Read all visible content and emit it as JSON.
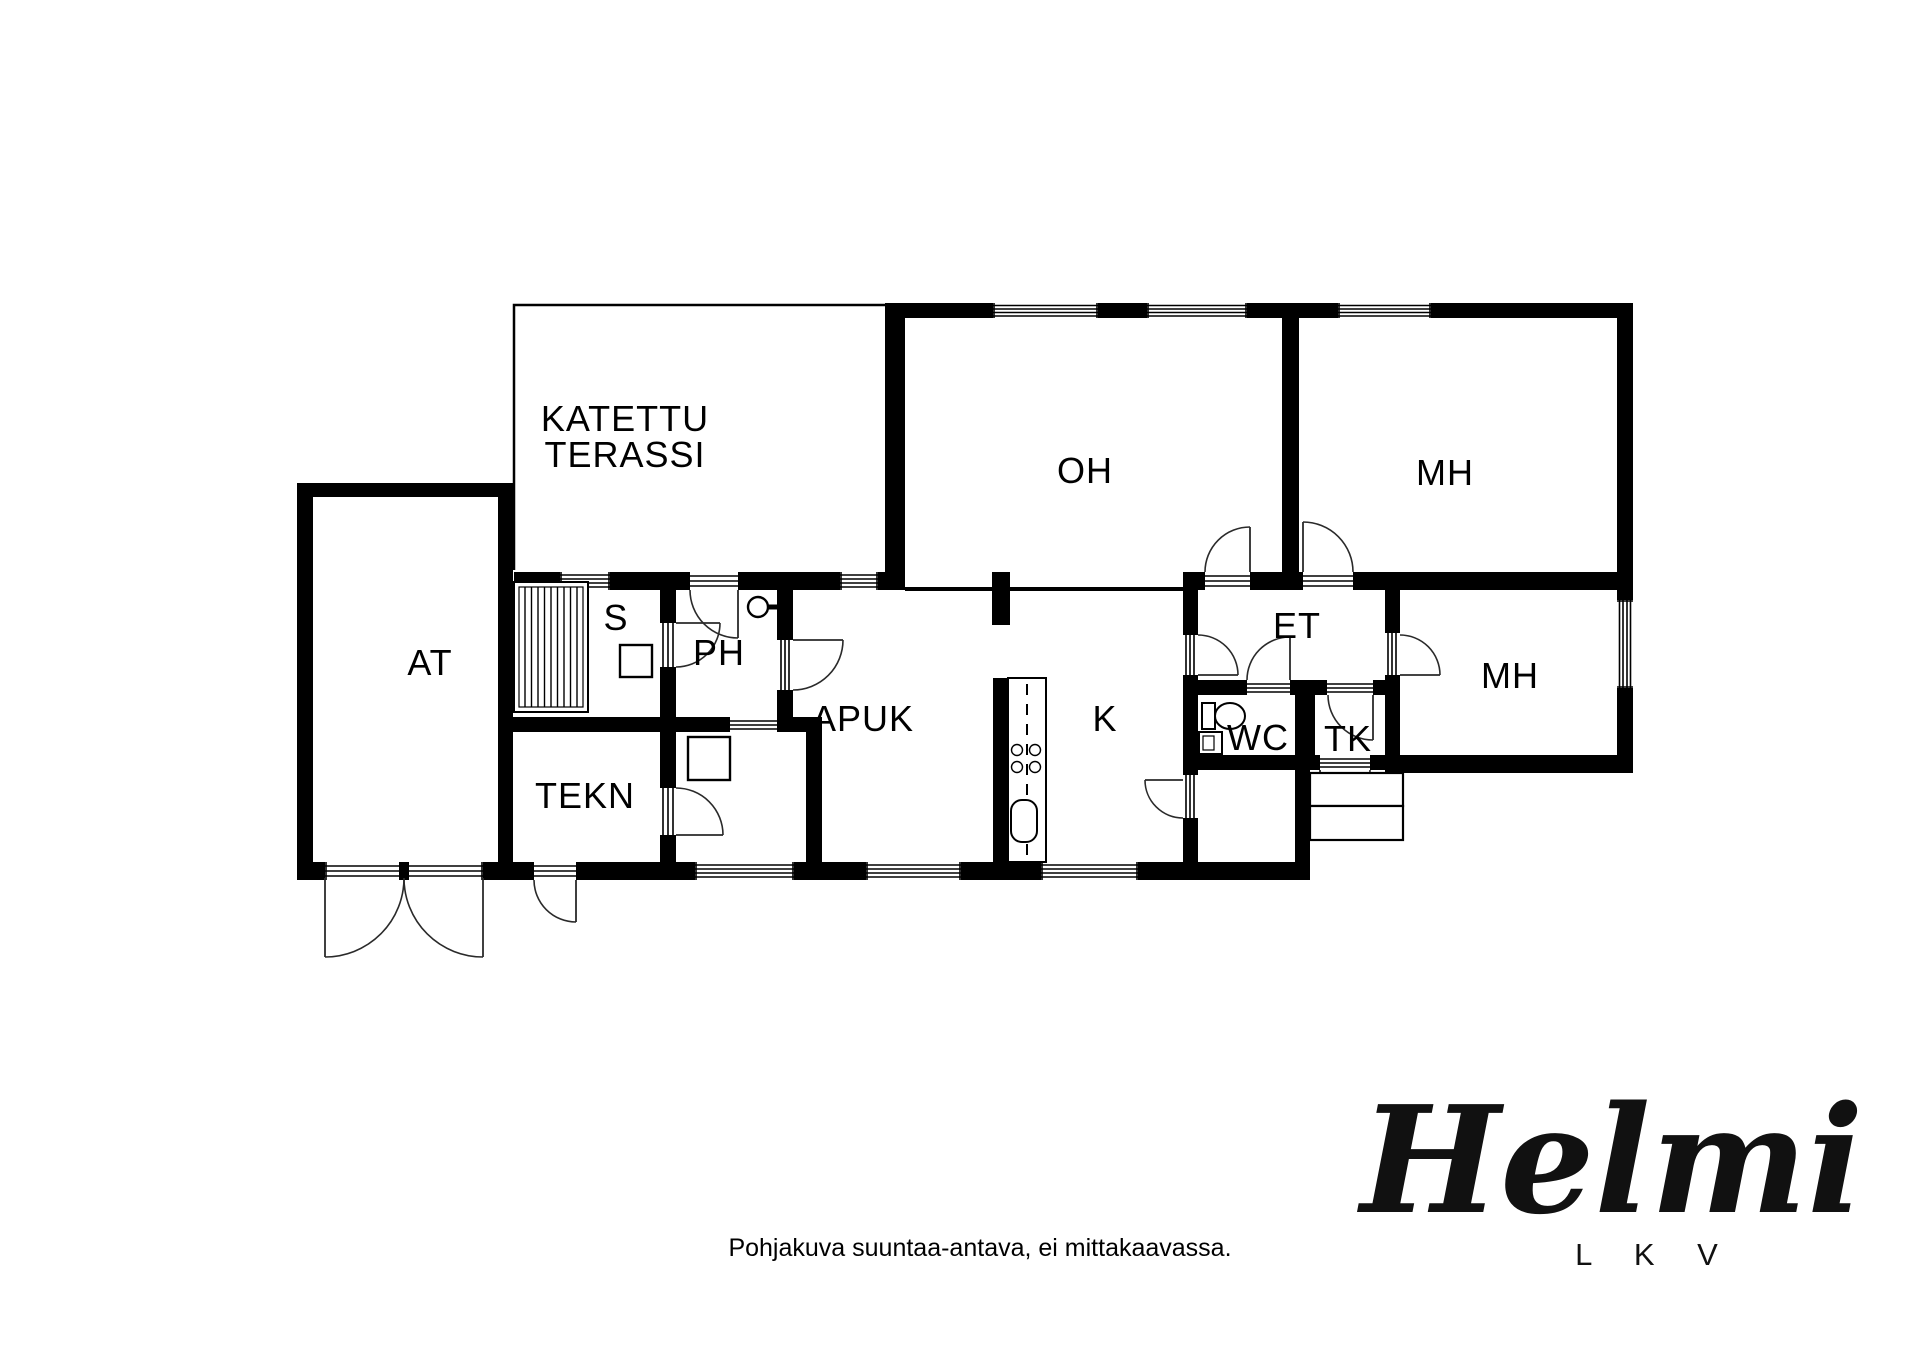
{
  "colors": {
    "wall": "#000000",
    "background": "#ffffff"
  },
  "labels": {
    "terrace_line1": "KATETTU",
    "terrace_line2": "TERASSI",
    "oh": "OH",
    "mh_top": "MH",
    "mh_right": "MH",
    "at": "AT",
    "s": "S",
    "ph": "PH",
    "apuk": "APUK",
    "k": "K",
    "et": "ET",
    "wc": "WC",
    "tk": "TK",
    "tekn": "TEKN"
  },
  "footer": {
    "disclaimer": "Pohjakuva suuntaa-antava, ei mittakaavassa."
  },
  "logo": {
    "name": "Helmi",
    "subtitle": "L K V"
  }
}
